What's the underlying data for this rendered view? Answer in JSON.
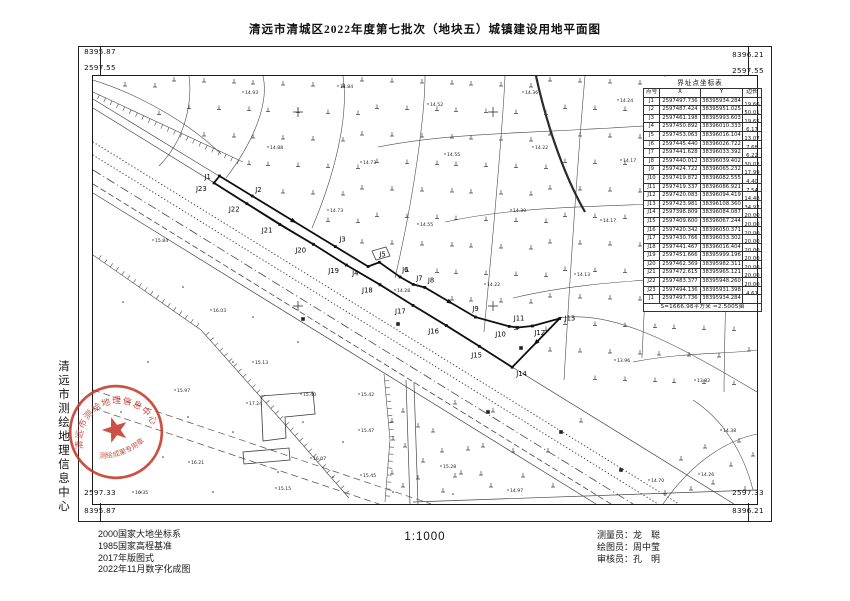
{
  "title": "清远市清城区2022年度第七批次（地块五）城镇建设用地平面图",
  "scale": "1:1000",
  "corners": {
    "tl_easting": "8395.87",
    "tl_northing": "2597.55",
    "tr_easting": "8396.21",
    "tr_northing": "2597.55",
    "bl_northing": "2597.33",
    "bl_easting": "8395.87",
    "br_northing": "2597.33",
    "br_easting": "8396.21"
  },
  "sidebar_org": "清远市测绘地理信息中心",
  "seal": {
    "ring_text": "清远市测绘地理信息中心",
    "banner_text": "测绘成果专用章",
    "color": "#c5392b"
  },
  "notes": [
    "2000国家大地坐标系",
    "1985国家高程基准",
    "2017年版图式",
    "2022年11月数字化成图"
  ],
  "credits": [
    {
      "label": "测量员：",
      "name": "龙　聪"
    },
    {
      "label": "绘图员：",
      "name": "周中莹"
    },
    {
      "label": "审核员：",
      "name": "孔　明"
    }
  ],
  "table": {
    "title": "界址点坐标表",
    "columns": [
      "点号",
      "X",
      "Y",
      "边长"
    ],
    "rows": [
      [
        "J1",
        "2597497.736",
        "38395934.284",
        "19.66"
      ],
      [
        "J2",
        "2597487.424",
        "38395951.025",
        "50.01"
      ],
      [
        "J3",
        "2597461.198",
        "38395993.603",
        "19.65"
      ],
      [
        "J4",
        "2597450.892",
        "38396010.333",
        "6.17"
      ],
      [
        "J5",
        "2597453.063",
        "38396016.104",
        "13.07"
      ],
      [
        "J6",
        "2597445.440",
        "38396026.722",
        "7.68"
      ],
      [
        "J7",
        "2597441.628",
        "38396033.392",
        "6.22"
      ],
      [
        "J8",
        "2597440.012",
        "38396039.402",
        "30.02"
      ],
      [
        "J9",
        "2597424.722",
        "38396065.232",
        "17.99"
      ],
      [
        "J10",
        "2597419.872",
        "38396082.555",
        "4.40"
      ],
      [
        "J11",
        "2597419.337",
        "38396086.921",
        "7.54"
      ],
      [
        "J12",
        "2597420.083",
        "38396094.419",
        "14.48"
      ],
      [
        "J13",
        "2597423.981",
        "38396108.360",
        "34.97"
      ],
      [
        "J14",
        "2597398.809",
        "38396084.087",
        "20.00"
      ],
      [
        "J15",
        "2597409.600",
        "38396067.244",
        "20.00"
      ],
      [
        "J16",
        "2597420.342",
        "38396050.371",
        "20.00"
      ],
      [
        "J17",
        "2597430.766",
        "38396033.302",
        "20.00"
      ],
      [
        "J18",
        "2597441.467",
        "38396016.404",
        "20.00"
      ],
      [
        "J19",
        "2597451.666",
        "38395999.196",
        "20.00"
      ],
      [
        "J20",
        "2597462.369",
        "38395982.311",
        "20.00"
      ],
      [
        "J21",
        "2597472.615",
        "38395965.121",
        "20.00"
      ],
      [
        "J22",
        "2597483.377",
        "38395948.260",
        "20.00"
      ],
      [
        "J23",
        "2597494.136",
        "38395931.398",
        "4.61"
      ],
      [
        "J1",
        "2597497.736",
        "38395934.284",
        ""
      ]
    ],
    "footer": "S=1666.98平方米 ≈2.5005亩"
  },
  "map": {
    "boundary": {
      "points": [
        {
          "id": "J1",
          "x": 126.5,
          "y": 100,
          "dx": -15,
          "dy": 3
        },
        {
          "id": "J2",
          "x": 159.2,
          "y": 120,
          "dx": 3,
          "dy": -4
        },
        {
          "id": "J3",
          "x": 242.4,
          "y": 170.6,
          "dx": 4,
          "dy": -5
        },
        {
          "id": "J4",
          "x": 275.1,
          "y": 190.5,
          "dx": -16,
          "dy": 9
        },
        {
          "id": "J5",
          "x": 286.4,
          "y": 186.3,
          "dx": 0,
          "dy": -6
        },
        {
          "id": "J6",
          "x": 307.1,
          "y": 201.0,
          "dx": 2,
          "dy": -5
        },
        {
          "id": "J7",
          "x": 320.2,
          "y": 208.4,
          "dx": 3,
          "dy": -4
        },
        {
          "id": "J8",
          "x": 331.9,
          "y": 211.5,
          "dx": 3,
          "dy": -5
        },
        {
          "id": "J9",
          "x": 382.4,
          "y": 241.1,
          "dx": -3,
          "dy": -6
        },
        {
          "id": "J10",
          "x": 416.2,
          "y": 250.4,
          "dx": -14,
          "dy": 10
        },
        {
          "id": "J11",
          "x": 424.7,
          "y": 251.5,
          "dx": -4,
          "dy": -7
        },
        {
          "id": "J12",
          "x": 439.4,
          "y": 250.0,
          "dx": 2,
          "dy": 9
        },
        {
          "id": "J13",
          "x": 466.6,
          "y": 242.5,
          "dx": 5,
          "dy": 2
        },
        {
          "id": "J14",
          "x": 419.2,
          "y": 291.2,
          "dx": 4,
          "dy": 9
        },
        {
          "id": "J15",
          "x": 386.3,
          "y": 270.3,
          "dx": -8,
          "dy": 11
        },
        {
          "id": "J16",
          "x": 353.3,
          "y": 249.5,
          "dx": -18,
          "dy": 8
        },
        {
          "id": "J17",
          "x": 320.0,
          "y": 229.4,
          "dx": -18,
          "dy": 8
        },
        {
          "id": "J18",
          "x": 287.0,
          "y": 208.7,
          "dx": -18,
          "dy": 8
        },
        {
          "id": "J19",
          "x": 253.3,
          "y": 189.0,
          "dx": -18,
          "dy": 8
        },
        {
          "id": "J20",
          "x": 220.4,
          "y": 168.3,
          "dx": -18,
          "dy": 8
        },
        {
          "id": "J21",
          "x": 186.8,
          "y": 148.5,
          "dx": -18,
          "dy": 8
        },
        {
          "id": "J22",
          "x": 153.9,
          "y": 127.7,
          "dx": -18,
          "dy": 8
        },
        {
          "id": "J23",
          "x": 121.0,
          "y": 106.9,
          "dx": -18,
          "dy": 8
        }
      ]
    },
    "roads": [
      {
        "cls": "sld",
        "pts": [
          [
            0,
            32
          ],
          [
            641,
            428
          ]
        ]
      },
      {
        "cls": "sld",
        "pts": [
          [
            0,
            23
          ],
          [
            126,
            100
          ]
        ]
      },
      {
        "cls": "dot",
        "pts": [
          [
            0,
            66
          ],
          [
            586,
            428
          ]
        ]
      },
      {
        "cls": "dot",
        "pts": [
          [
            0,
            79
          ],
          [
            565,
            428
          ]
        ]
      },
      {
        "cls": "dd",
        "pts": [
          [
            0,
            94
          ],
          [
            540,
            428
          ]
        ]
      },
      {
        "cls": "ds",
        "pts": [
          [
            0,
            108
          ],
          [
            518,
            428
          ]
        ]
      },
      {
        "cls": "sld",
        "pts": [
          [
            0,
            117
          ],
          [
            503,
            428
          ]
        ]
      },
      {
        "cls": "tr",
        "pts": [
          [
            0,
            314
          ],
          [
            338,
            428
          ]
        ]
      },
      {
        "cls": "tr",
        "pts": [
          [
            0,
            332
          ],
          [
            286,
            428
          ]
        ]
      },
      {
        "cls": "sld",
        "pts": [
          [
            313,
            304
          ],
          [
            317,
            428
          ]
        ]
      },
      {
        "cls": "sld",
        "pts": [
          [
            321,
            306
          ],
          [
            325,
            428
          ]
        ]
      },
      {
        "cls": "sld",
        "pts": [
          [
            320,
            426
          ],
          [
            664,
            414
          ]
        ]
      }
    ],
    "parcels": [
      "M96,0 C100,30 90,66 66,90",
      "M170,0 C176,26 162,64 133,102",
      "M250,0 C256,40 242,98 219,152",
      "M332,0 C332,36 322,116 302,202",
      "M412,0 C410,48 402,138 391,256",
      "M492,0 C487,58 480,148 471,304",
      "M572,0 C562,68 554,166 549,282",
      "M648,0 C640,76 632,176 631,316",
      "M285,71 C380,52 480,60 664,40",
      "M352,146 C452,124 562,134 664,120",
      "M420,222 C512,200 600,206 664,192",
      "M540,286 C590,276 640,278 664,274",
      "M0,4 C45,18 95,46 128,78",
      "M466,242 C520,234 580,266 664,316",
      "M600,324 C628,342 650,374 660,414",
      "M570,428 C600,384 636,364 664,358"
    ],
    "thick": [
      "M443,0 C452,41 468,94 492,136"
    ],
    "buildings": [
      "M168,320 L220,316 L222,338 L192,341 L193,362 L170,365 Z",
      "M150,376 L196,372 L197,384 L151,388 Z",
      "M279,175 L293,171 L297,180 L283,184 Z"
    ],
    "combs": [
      {
        "side": 1,
        "pts": [
          [
            0,
            16
          ],
          [
            150,
            86
          ]
        ]
      },
      {
        "side": -1,
        "pts": [
          [
            0,
            179
          ],
          [
            108,
            254
          ],
          [
            188,
            344
          ],
          [
            256,
            422
          ]
        ]
      },
      {
        "side": -1,
        "pts": [
          [
            291,
            298
          ],
          [
            297,
            364
          ],
          [
            292,
            426
          ]
        ]
      }
    ],
    "veg": {
      "regions": [
        {
          "x0": 30,
          "x1": 652,
          "sx": 27,
          "y0": 8,
          "y1": 330,
          "sy": 27,
          "m": 0.617,
          "b": 12,
          "side": "lt"
        },
        {
          "x0": 300,
          "x1": 500,
          "sx": 30,
          "y0": 140,
          "y1": 422,
          "sy": 26,
          "m": 0.618,
          "b": 131,
          "side": "gt"
        }
      ],
      "extra": [
        [
          310,
          336
        ],
        [
          340,
          356
        ],
        [
          362,
          328
        ],
        [
          390,
          371
        ],
        [
          330,
          386
        ],
        [
          368,
          398
        ],
        [
          400,
          336
        ],
        [
          420,
          376
        ],
        [
          310,
          411
        ],
        [
          350,
          416
        ],
        [
          398,
          411
        ],
        [
          430,
          401
        ],
        [
          455,
          376
        ],
        [
          460,
          411
        ],
        [
          488,
          346
        ],
        [
          300,
          364
        ],
        [
          588,
          384
        ],
        [
          612,
          372
        ],
        [
          638,
          390
        ],
        [
          652,
          414
        ],
        [
          620,
          408
        ],
        [
          598,
          414
        ],
        [
          646,
          366
        ],
        [
          660,
          380
        ],
        [
          572,
          418
        ]
      ]
    },
    "dots": [
      [
        30,
        226
      ],
      [
        55,
        286
      ],
      [
        95,
        341
      ],
      [
        140,
        286
      ],
      [
        70,
        381
      ],
      [
        120,
        416
      ],
      [
        185,
        396
      ],
      [
        28,
        336
      ],
      [
        160,
        241
      ],
      [
        210,
        346
      ],
      [
        240,
        401
      ],
      [
        90,
        211
      ],
      [
        205,
        266
      ],
      [
        48,
        416
      ],
      [
        250,
        366
      ],
      [
        300,
        416
      ],
      [
        360,
        418
      ],
      [
        140,
        356
      ]
    ],
    "elevations": [
      [
        150,
        16,
        "14.93"
      ],
      [
        245,
        10,
        "14.84"
      ],
      [
        335,
        28,
        "14.52"
      ],
      [
        430,
        16,
        "14.36"
      ],
      [
        525,
        24,
        "14.24"
      ],
      [
        612,
        12,
        "14.05"
      ],
      [
        175,
        71,
        "14.88"
      ],
      [
        268,
        86,
        "14.73"
      ],
      [
        352,
        78,
        "14.55"
      ],
      [
        440,
        71,
        "14.22"
      ],
      [
        528,
        84,
        "14.17"
      ],
      [
        615,
        76,
        "14.12"
      ],
      [
        235,
        134,
        "14.73"
      ],
      [
        325,
        148,
        "14.55"
      ],
      [
        418,
        134,
        "14.30"
      ],
      [
        508,
        144,
        "14.17"
      ],
      [
        598,
        138,
        "14.08"
      ],
      [
        650,
        158,
        "13.94"
      ],
      [
        302,
        214,
        "14.28"
      ],
      [
        392,
        208,
        "14.22"
      ],
      [
        482,
        198,
        "14.13"
      ],
      [
        568,
        214,
        "13.87"
      ],
      [
        640,
        234,
        "13.75"
      ],
      [
        522,
        284,
        "13.96"
      ],
      [
        602,
        304,
        "13.82"
      ],
      [
        628,
        354,
        "14.38"
      ],
      [
        606,
        398,
        "14.26"
      ],
      [
        556,
        404,
        "14.70"
      ],
      [
        60,
        164,
        "15.84"
      ],
      [
        118,
        234,
        "16.03"
      ],
      [
        82,
        314,
        "15.97"
      ],
      [
        160,
        286,
        "15.13"
      ],
      [
        154,
        327,
        "17.24"
      ],
      [
        208,
        318,
        "15.40"
      ],
      [
        266,
        318,
        "15.42"
      ],
      [
        266,
        354,
        "15.47"
      ],
      [
        268,
        399,
        "15.45"
      ],
      [
        218,
        382,
        "16.07"
      ],
      [
        183,
        412,
        "15.15"
      ],
      [
        96,
        386,
        "16.21"
      ],
      [
        40,
        416,
        "16.35"
      ],
      [
        348,
        390,
        "15.28"
      ],
      [
        415,
        414,
        "14.97"
      ]
    ],
    "crosses": [
      [
        205,
        36
      ],
      [
        400,
        36
      ],
      [
        595,
        36
      ],
      [
        205,
        230
      ],
      [
        400,
        230
      ],
      [
        595,
        230
      ]
    ],
    "squares": [
      [
        210,
        243
      ],
      [
        305,
        248
      ],
      [
        428,
        272
      ],
      [
        395,
        336
      ],
      [
        468,
        356
      ],
      [
        528,
        394
      ]
    ]
  }
}
